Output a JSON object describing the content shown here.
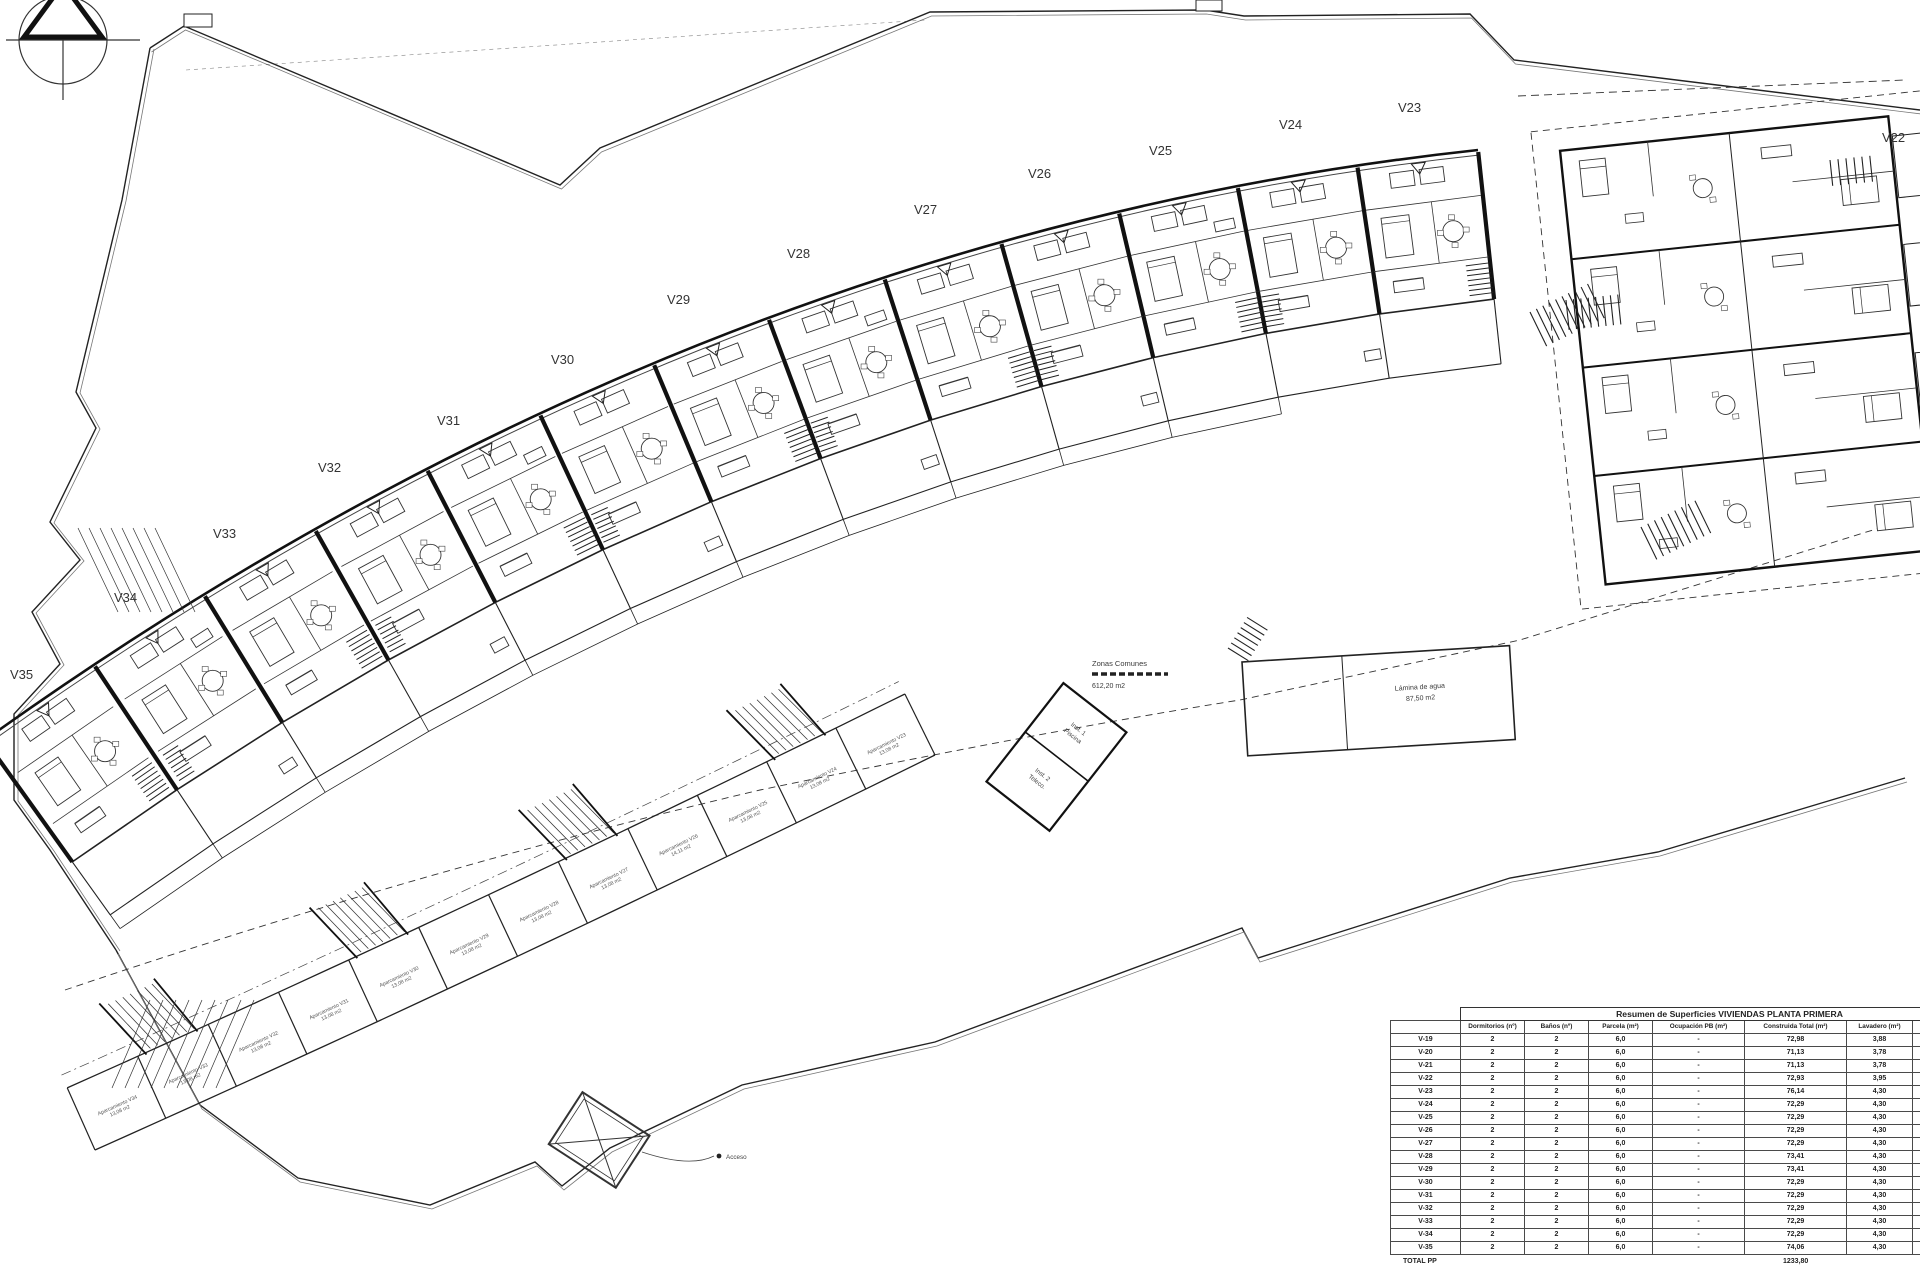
{
  "plan": {
    "unit_labels": [
      {
        "label": "V35",
        "x": 10,
        "y": 679
      },
      {
        "label": "V34",
        "x": 114,
        "y": 602
      },
      {
        "label": "V33",
        "x": 213,
        "y": 538
      },
      {
        "label": "V32",
        "x": 318,
        "y": 472
      },
      {
        "label": "V31",
        "x": 437,
        "y": 425
      },
      {
        "label": "V30",
        "x": 551,
        "y": 364
      },
      {
        "label": "V29",
        "x": 667,
        "y": 304
      },
      {
        "label": "V28",
        "x": 787,
        "y": 258
      },
      {
        "label": "V27",
        "x": 914,
        "y": 214
      },
      {
        "label": "V26",
        "x": 1028,
        "y": 178
      },
      {
        "label": "V25",
        "x": 1149,
        "y": 155
      },
      {
        "label": "V24",
        "x": 1279,
        "y": 129
      },
      {
        "label": "V23",
        "x": 1398,
        "y": 112
      },
      {
        "label": "V22",
        "x": 1882,
        "y": 142
      }
    ],
    "annotations": {
      "zonas_comunes_line1": "Zonas Comunes",
      "zonas_comunes_line2": "612,20 m2",
      "lamina_line1": "Lámina de agua",
      "lamina_line2": "87,50 m2",
      "inst1_line1": "Inst. 1",
      "inst1_line2": "Piscina",
      "inst2_line1": "Inst. 2",
      "inst2_line2": "Teleco.",
      "acceso": "Acceso"
    },
    "parking_labels": [
      {
        "unit": "Aparcamiento V34",
        "area": "13,08 m2"
      },
      {
        "unit": "Aparcamiento V33",
        "area": "13,08 m2"
      },
      {
        "unit": "Aparcamiento V32",
        "area": "13,08 m2"
      },
      {
        "unit": "Aparcamiento V31",
        "area": "13,08 m2"
      },
      {
        "unit": "Aparcamiento V30",
        "area": "13,08 m2"
      },
      {
        "unit": "Aparcamiento V29",
        "area": "13,08 m2"
      },
      {
        "unit": "Aparcamiento V28",
        "area": "13,08 m2"
      },
      {
        "unit": "Aparcamiento V27",
        "area": "13,08 m2"
      },
      {
        "unit": "Aparcamiento V26",
        "area": "14,11 m2"
      },
      {
        "unit": "Aparcamiento V25",
        "area": "13,08 m2"
      },
      {
        "unit": "Aparcamiento V24",
        "area": "13,08 m2"
      },
      {
        "unit": "Aparcamiento V23",
        "area": "13,08 m2"
      }
    ]
  },
  "table": {
    "title": "Resumen de Superficies VIVIENDAS PLANTA PRIMERA",
    "columns": [
      "",
      "Dormitorios (nº)",
      "Baños (nº)",
      "Parcela (m²)",
      "Ocupación PB (m²)",
      "Construida Total (m²)",
      "Lavadero (m²)",
      "Terrazas (m²)"
    ],
    "rows": [
      [
        "V-19",
        "2",
        "2",
        "6,0",
        "-",
        "72,98",
        "3,88",
        "10,4"
      ],
      [
        "V-20",
        "2",
        "2",
        "6,0",
        "-",
        "71,13",
        "3,78",
        "5,1"
      ],
      [
        "V-21",
        "2",
        "2",
        "6,0",
        "-",
        "71,13",
        "3,78",
        "5,1"
      ],
      [
        "V-22",
        "2",
        "2",
        "6,0",
        "-",
        "72,93",
        "3,95",
        "10,4"
      ],
      [
        "V-23",
        "2",
        "2",
        "6,0",
        "-",
        "76,14",
        "4,30",
        "10,4"
      ],
      [
        "V-24",
        "2",
        "2",
        "6,0",
        "-",
        "72,29",
        "4,30",
        "5,1"
      ],
      [
        "V-25",
        "2",
        "2",
        "6,0",
        "-",
        "72,29",
        "4,30",
        "5,1"
      ],
      [
        "V-26",
        "2",
        "2",
        "6,0",
        "-",
        "72,29",
        "4,30",
        "5,1"
      ],
      [
        "V-27",
        "2",
        "2",
        "6,0",
        "-",
        "72,29",
        "4,30",
        "5,1"
      ],
      [
        "V-28",
        "2",
        "2",
        "6,0",
        "-",
        "73,41",
        "4,30",
        "5,1"
      ],
      [
        "V-29",
        "2",
        "2",
        "6,0",
        "-",
        "73,41",
        "4,30",
        "5,1"
      ],
      [
        "V-30",
        "2",
        "2",
        "6,0",
        "-",
        "72,29",
        "4,30",
        "5,1"
      ],
      [
        "V-31",
        "2",
        "2",
        "6,0",
        "-",
        "72,29",
        "4,30",
        "5,1"
      ],
      [
        "V-32",
        "2",
        "2",
        "6,0",
        "-",
        "72,29",
        "4,30",
        "5,1"
      ],
      [
        "V-33",
        "2",
        "2",
        "6,0",
        "-",
        "72,29",
        "4,30",
        "5,1"
      ],
      [
        "V-34",
        "2",
        "2",
        "6,0",
        "-",
        "72,29",
        "4,30",
        "5,1"
      ],
      [
        "V-35",
        "2",
        "2",
        "6,0",
        "-",
        "74,06",
        "4,30",
        "5,1"
      ]
    ],
    "total_label": "TOTAL PP",
    "total_value": "1233,80"
  },
  "colors": {
    "line": "#1c1c1c",
    "light": "#6b6b6b",
    "paper": "#ffffff"
  }
}
